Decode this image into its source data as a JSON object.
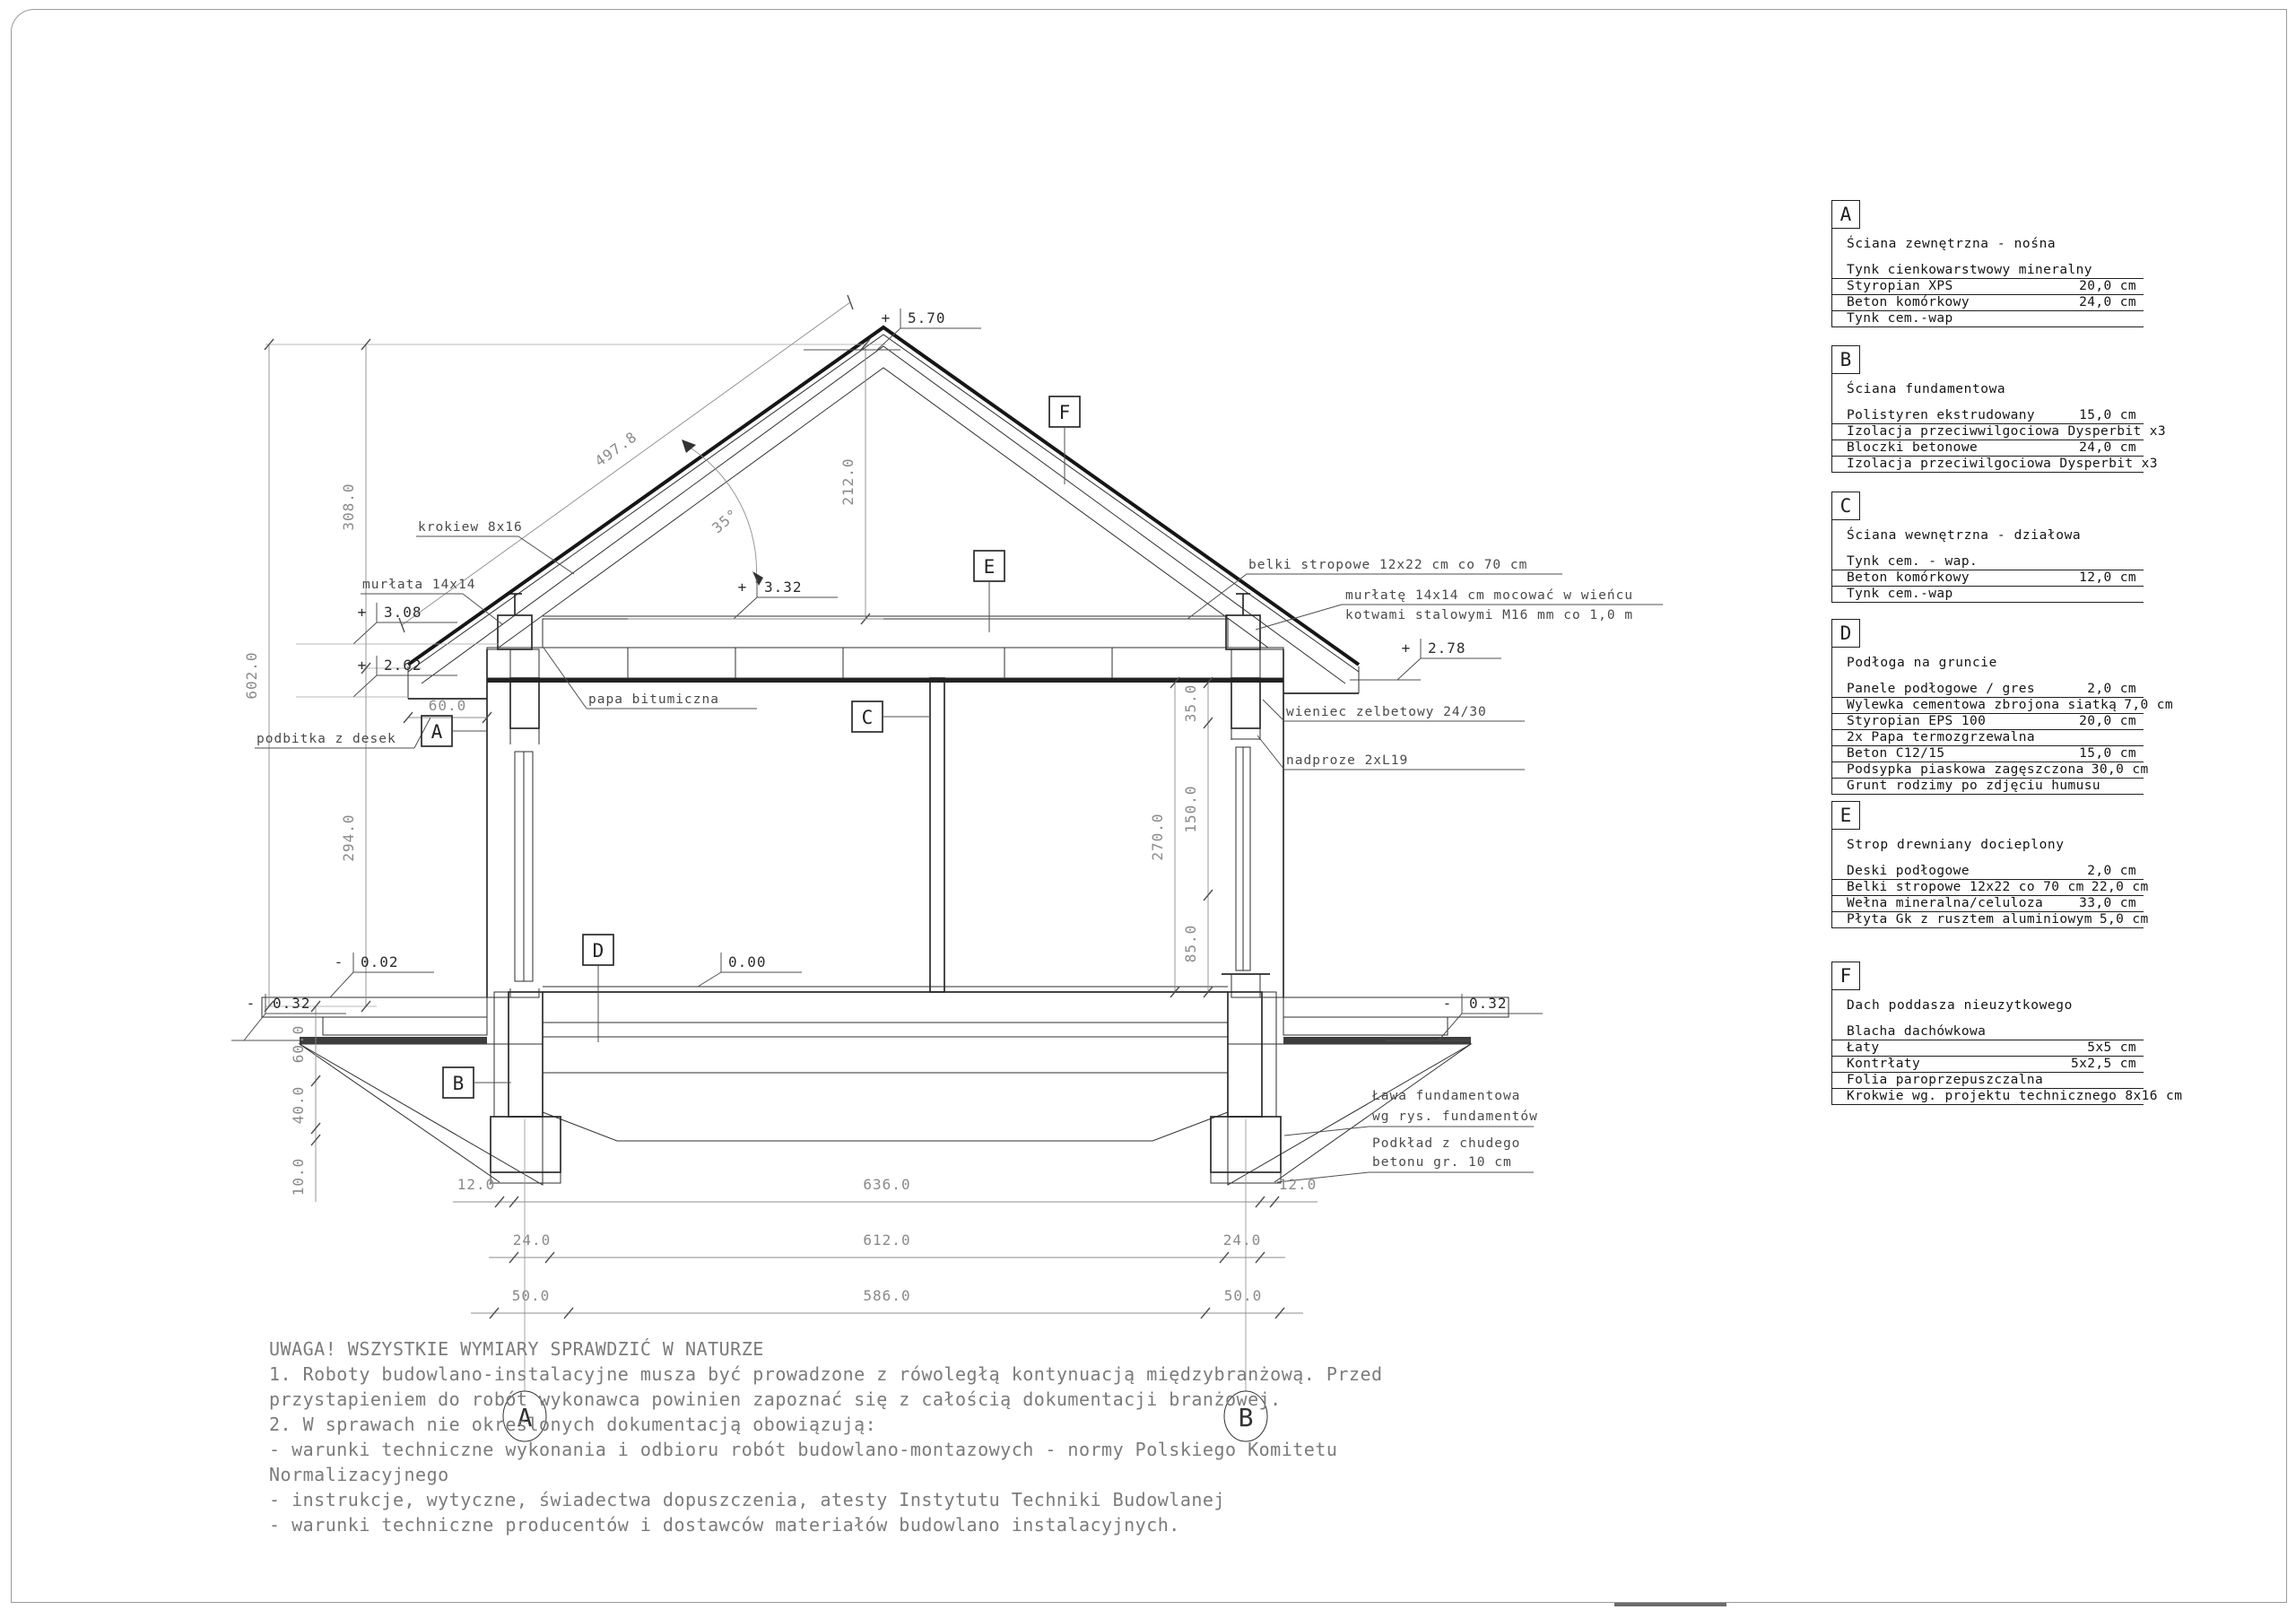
{
  "drawing": {
    "levels": {
      "ridge": {
        "sign": "+",
        "value": "5.70"
      },
      "attic": {
        "sign": "+",
        "value": "3.32"
      },
      "murlata": {
        "sign": "+",
        "value": "3.08"
      },
      "eave_left": {
        "sign": "+",
        "value": "2.62"
      },
      "eave_right": {
        "sign": "+",
        "value": "2.78"
      },
      "floor": {
        "sign": "",
        "value": "0.00"
      },
      "terrace": {
        "sign": "-",
        "value": "0.02"
      },
      "ground_left": {
        "sign": "-",
        "value": "0.32"
      },
      "ground_right": {
        "sign": "-",
        "value": "0.32"
      }
    },
    "dims": {
      "total_height": "602.0",
      "roof_zone": "308.0",
      "wall_zone": "294.0",
      "ridge_offset": "212.0",
      "rafter_length": "497.8",
      "roof_angle": "35°",
      "eave_overhang": "60.0",
      "right_total": "270.0",
      "right_top": "35.0",
      "right_mid": "150.0",
      "right_bot": "85.0",
      "depth1": "60.0",
      "depth2": "40.0",
      "depth3": "10.0",
      "b1l": "12.0",
      "b1c": "636.0",
      "b1r": "12.0",
      "b2l": "24.0",
      "b2c": "612.0",
      "b2r": "24.0",
      "b3l": "50.0",
      "b3c": "586.0",
      "b3r": "50.0"
    },
    "leaders": {
      "krokiew": "krokiew 8x16",
      "murlata": "murłata 14x14",
      "podbitka": "podbitka z desek",
      "papa": "papa bitumiczna",
      "belki": "belki stropowe 12x22 cm co 70 cm",
      "anchor1": "murłatę 14x14 cm mocować w wieńcu",
      "anchor2": "kotwami stalowymi M16 mm co 1,0 m",
      "wieniec": "wieniec zelbetowy 24/30",
      "nadproze": "nadproze 2xL19",
      "lawa1": "Ława fundamentowa",
      "lawa2": "wg rys. fundamentów",
      "podklad1": "Podkład z chudego",
      "podklad2": "betonu gr. 10 cm"
    },
    "markers": {
      "a": "A",
      "b": "B",
      "c": "C",
      "d": "D",
      "e": "E",
      "f": "F"
    },
    "axes": {
      "a": "A",
      "b": "B"
    }
  },
  "legend": {
    "blocks": [
      {
        "letter": "A",
        "title": "Ściana zewnętrzna - nośna",
        "rows": [
          {
            "name": "Tynk cienkowarstwowy mineralny",
            "value": ""
          },
          {
            "name": "Styropian XPS",
            "value": "20,0 cm"
          },
          {
            "name": "Beton komórkowy",
            "value": "24,0 cm"
          },
          {
            "name": "Tynk cem.-wap",
            "value": ""
          }
        ]
      },
      {
        "letter": "B",
        "title": "Ściana fundamentowa",
        "rows": [
          {
            "name": "Polistyren ekstrudowany",
            "value": "15,0 cm"
          },
          {
            "name": "Izolacja przeciwwilgociowa Dysperbit x3",
            "value": ""
          },
          {
            "name": "Bloczki betonowe",
            "value": "24,0 cm"
          },
          {
            "name": "Izolacja przeciwilgociowa Dysperbit x3",
            "value": ""
          }
        ]
      },
      {
        "letter": "C",
        "title": "Ściana wewnętrzna - działowa",
        "rows": [
          {
            "name": "Tynk cem. - wap.",
            "value": ""
          },
          {
            "name": "Beton komórkowy",
            "value": "12,0 cm"
          },
          {
            "name": "Tynk cem.-wap",
            "value": ""
          }
        ]
      },
      {
        "letter": "D",
        "title": "Podłoga na gruncie",
        "rows": [
          {
            "name": "Panele podłogowe / gres",
            "value": "2,0 cm"
          },
          {
            "name": "Wylewka cementowa zbrojona siatką",
            "value": "7,0 cm"
          },
          {
            "name": "Styropian EPS 100",
            "value": "20,0 cm"
          },
          {
            "name": "2x Papa termozgrzewalna",
            "value": ""
          },
          {
            "name": "Beton C12/15",
            "value": "15,0 cm"
          },
          {
            "name": "Podsypka piaskowa zagęszczona",
            "value": "30,0 cm"
          },
          {
            "name": "Grunt rodzimy po zdjęciu humusu",
            "value": ""
          }
        ]
      },
      {
        "letter": "E",
        "title": "Strop drewniany docieplony",
        "rows": [
          {
            "name": "Deski podłogowe",
            "value": "2,0 cm"
          },
          {
            "name": "Belki stropowe 12x22 co 70 cm",
            "value": "22,0 cm"
          },
          {
            "name": "Wełna mineralna/celuloza",
            "value": "33,0 cm"
          },
          {
            "name": "Płyta Gk z rusztem aluminiowym",
            "value": "5,0 cm"
          }
        ]
      },
      {
        "letter": "F",
        "title": "Dach poddasza nieuzytkowego",
        "rows": [
          {
            "name": "Blacha dachówkowa",
            "value": ""
          },
          {
            "name": "Łaty",
            "value": "5x5 cm"
          },
          {
            "name": "Kontrłaty",
            "value": "5x2,5 cm"
          },
          {
            "name": "Folia paroprzepuszczalna",
            "value": ""
          },
          {
            "name": "Krokwie wg. projektu technicznego 8x16 cm",
            "value": ""
          }
        ]
      }
    ]
  },
  "notes": {
    "lines": [
      "UWAGA! WSZYSTKIE WYMIARY SPRAWDZIĆ W NATURZE",
      "1. Roboty budowlano-instalacyjne musza być prowadzone z rówoległą kontynuacją międzybranżową. Przed",
      "przystapieniem do robót wykonawca powinien zapoznać się z całością dokumentacji branżowej.",
      "2. W sprawach nie okreslonych dokumentacją obowiązują:",
      "- warunki techniczne wykonania i odbioru robót budowlano-montazowych - normy Polskiego Komitetu",
      "Normalizacyjnego",
      "- instrukcje, wytyczne, świadectwa dopuszczenia, atesty Instytutu Techniki Budowlanej",
      "- warunki techniczne producentów i dostawców materiałów budowlano instalacyjnych."
    ]
  }
}
